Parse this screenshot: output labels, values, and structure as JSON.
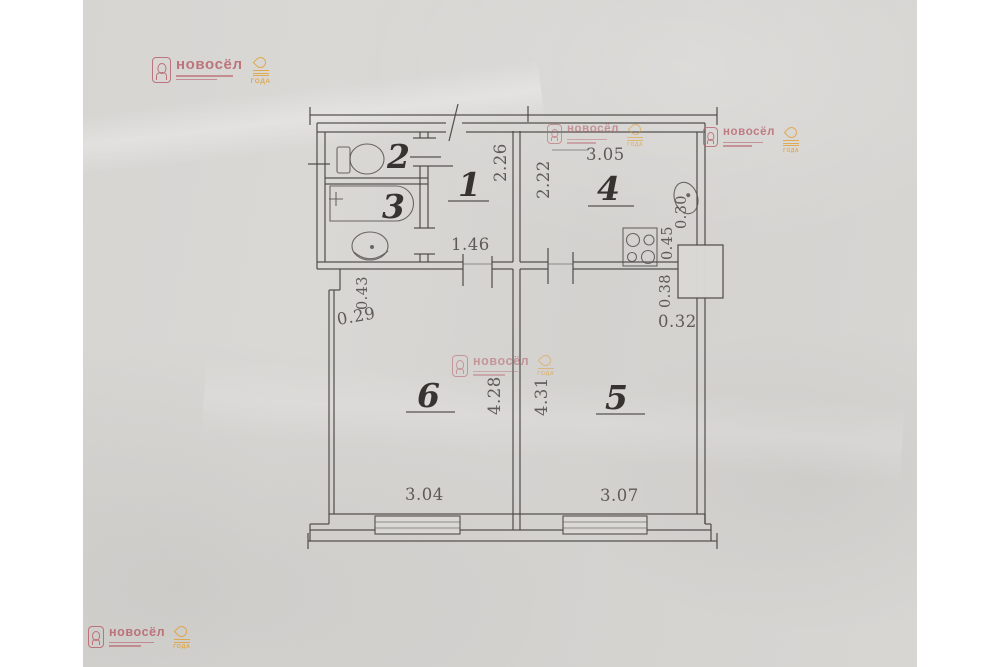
{
  "watermark": {
    "brand": "новосёл",
    "badge": "ГОДА"
  },
  "colors": {
    "paper": "#d7d5d2",
    "line": "#4a4643",
    "watermark_pink": "#b7646c",
    "watermark_orange": "#dfa13a"
  },
  "plan": {
    "rooms": {
      "r1": "1",
      "r2": "2",
      "r3": "3",
      "r4": "4",
      "r5": "5",
      "r6": "6"
    },
    "dimensions": {
      "hall_depth": "2.26",
      "hall_width": "1.46",
      "kitchen_depth": "2.22",
      "kitchen_width": "3.05",
      "room6_depth": "4.28",
      "room6_width": "3.04",
      "room5_depth": "4.31",
      "room5_width": "3.07",
      "seg_043": "0.43",
      "seg_029": "0.29",
      "seg_045": "0.45",
      "seg_030": "0.30",
      "seg_038": "0.38",
      "seg_032": "0.32"
    }
  }
}
